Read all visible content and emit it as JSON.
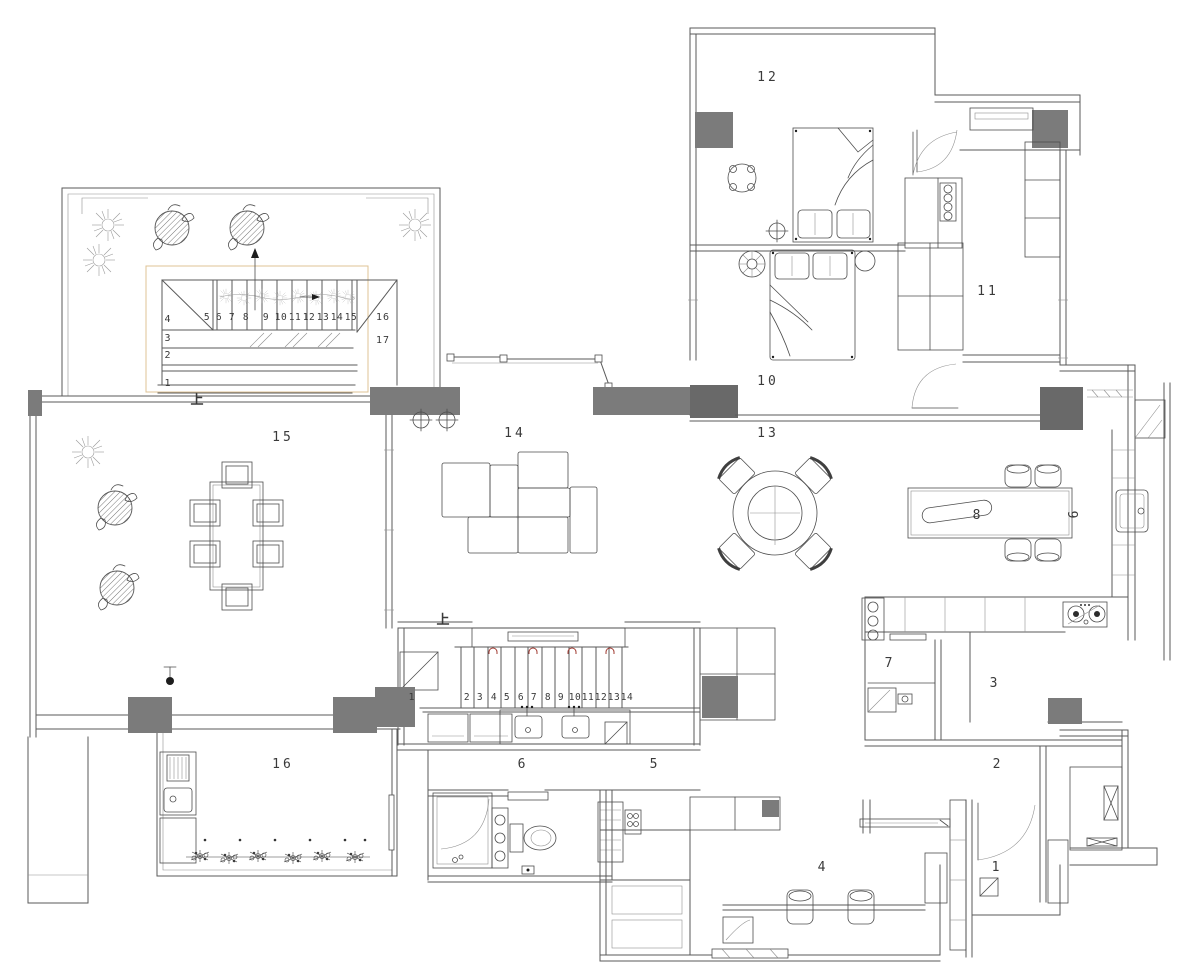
{
  "colors": {
    "background": "#ffffff",
    "wall_line": "#5a5a5a",
    "column_fill": "#7b7b7b",
    "accent_box": "#dfc394",
    "stair_marker_red": "#a23b32",
    "text": "#3a3a3a"
  },
  "rooms": {
    "r1": "1",
    "r2": "2",
    "r3": "3",
    "r4": "4",
    "r5": "5",
    "r6": "6",
    "r7": "7",
    "r8": "8",
    "r9": "9",
    "r10": "10",
    "r11": "11",
    "r12": "12",
    "r13": "13",
    "r14": "14",
    "r15": "15",
    "r16": "16"
  },
  "stairs": {
    "upper": {
      "side": [
        "4",
        "3",
        "2",
        "1"
      ],
      "run": [
        "5",
        "6",
        "7",
        "8",
        "9",
        "10",
        "11",
        "12",
        "13",
        "14",
        "15"
      ],
      "end": [
        "16",
        "17"
      ],
      "up": "上"
    },
    "lower": {
      "first": "1",
      "run": [
        "2",
        "3",
        "4",
        "5",
        "6",
        "7",
        "8",
        "9",
        "10",
        "11",
        "12",
        "13",
        "14"
      ],
      "up": "上"
    }
  }
}
